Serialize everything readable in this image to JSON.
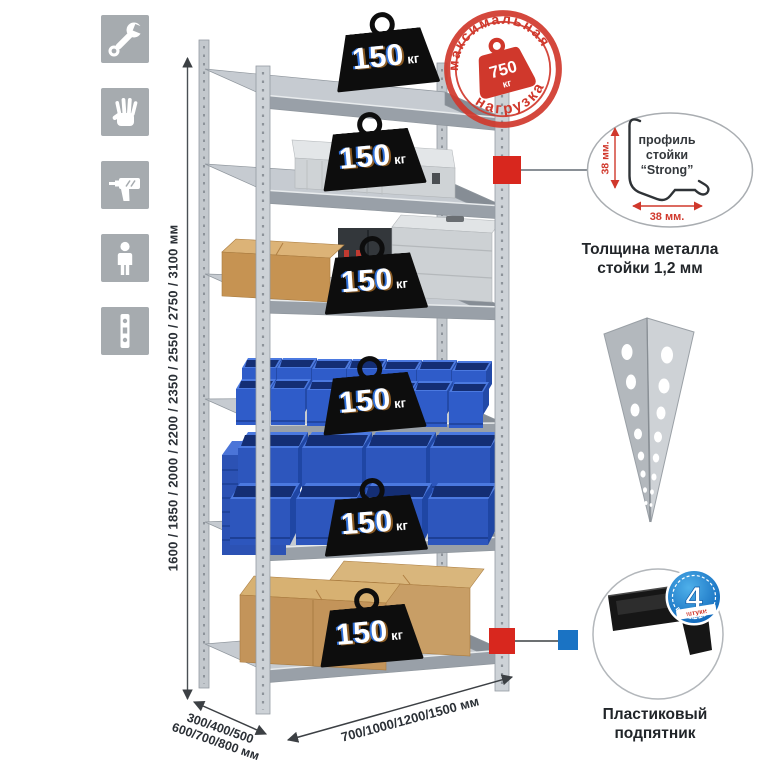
{
  "icons": [
    "wrench-icon",
    "gloves-icon",
    "drill-icon",
    "person-icon",
    "rack-post-icon"
  ],
  "dimensions": {
    "height": "1600 / 1850 / 2000 / 2200 / 2350 / 2550 / 2750 / 3100 мм",
    "depth_line1": "300/400/500",
    "depth_line2": "600/700/800 мм",
    "width": "700/1000/1200/1500 мм"
  },
  "max_load_stamp": {
    "arc_top": "максимальная",
    "arc_bottom": "нагрузка",
    "value": "750",
    "unit": "кг"
  },
  "shelf_badges": [
    {
      "value": "150",
      "unit": "кг"
    },
    {
      "value": "150",
      "unit": "кг"
    },
    {
      "value": "150",
      "unit": "кг"
    },
    {
      "value": "150",
      "unit": "кг"
    },
    {
      "value": "150",
      "unit": "кг"
    },
    {
      "value": "150",
      "unit": "кг"
    }
  ],
  "profile_callout": {
    "line1": "профиль",
    "line2": "стойки",
    "line3": "“Strong”",
    "dim_vertical": "38 мм.",
    "dim_horizontal": "38 мм.",
    "caption_line1": "Толщина металла",
    "caption_line2": "стойки 1,2 мм"
  },
  "foot_callout": {
    "quantity": "4",
    "quantity_sub": "штуки",
    "arc_text": "в комплекте",
    "caption_line1": "Пластиковый",
    "caption_line2": "подпятник"
  },
  "colors": {
    "stamp_red": "#d0382c",
    "marker_red": "#d8271e",
    "marker_blue": "#1a73c4",
    "bin_blue": "#2f5cc9",
    "badge_blue": "#1f7fd0",
    "icon_gray": "#a6abaf"
  }
}
